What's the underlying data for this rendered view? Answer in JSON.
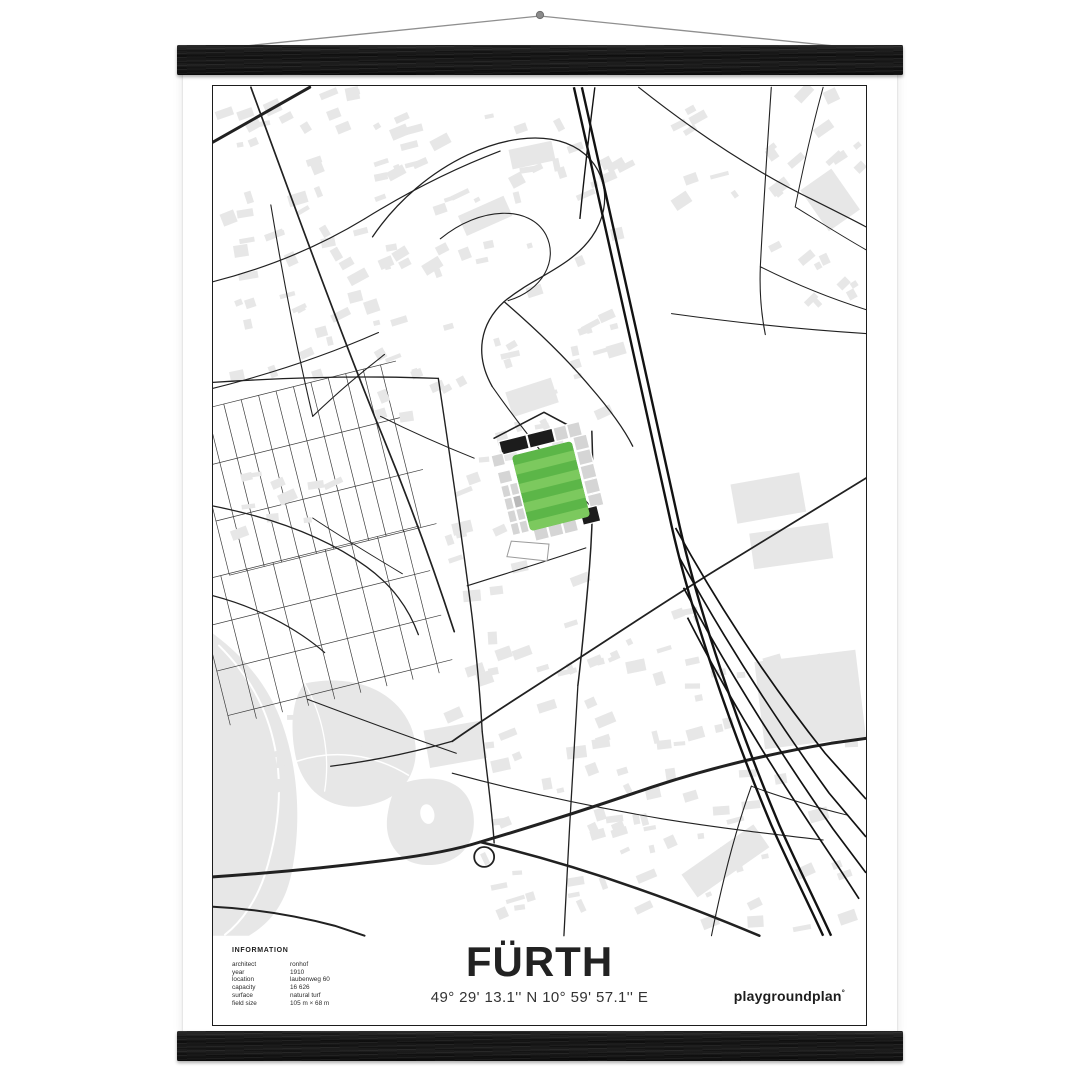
{
  "scene": {
    "wall_color": "#ffffff",
    "hanger_color": "#1a1a1a",
    "string_color": "#8f8f8f"
  },
  "poster": {
    "title": "FÜRTH",
    "coordinates": "49° 29' 13.1'' N  10° 59' 57.1'' E",
    "brand": "playgroundplan",
    "brand_mark": "°",
    "info": {
      "heading": "INFORMATION",
      "rows": [
        {
          "label": "architect",
          "value": "ronhof"
        },
        {
          "label": "year",
          "value": "1910"
        },
        {
          "label": "location",
          "value": "laubenweg 60"
        },
        {
          "label": "capacity",
          "value": "16 626"
        },
        {
          "label": "surface",
          "value": "natural turf"
        },
        {
          "label": "field size",
          "value": "105 m × 68 m"
        }
      ]
    }
  },
  "map": {
    "colors": {
      "road": "#212121",
      "rail": "#121212",
      "building": "#e7e7e7",
      "green": "#e7e7e7",
      "pitch": "#5cb648",
      "pitchStripe": "#7cc95e",
      "stand": "#d5d5d5",
      "standMid": "#b9b9b9",
      "standDark": "#1c1c1c",
      "grid": "#3c3c3c"
    },
    "greys": [
      "M0,548 C30,570 56,600 70,640 C86,686 88,738 80,782 C74,818 58,838 36,851 L0,851 Z",
      "M92,598 C140,588 182,604 198,640 C212,674 198,708 164,718 C126,730 94,712 84,676 C77,648 78,614 92,598 Z",
      "M190,698 C228,686 256,698 261,728 C266,762 242,782 212,780 C186,778 171,757 175,730 C178,712 181,704 190,698 Z"
    ],
    "whitePaths": [
      {
        "d": "M6,560 C36,590 54,622 62,662 C70,702 66,746 52,790 C44,814 30,836 12,850",
        "w": 2
      },
      {
        "d": "M84,676 C120,664 160,668 196,690",
        "w": 1.5
      },
      {
        "d": "M92,598 C110,630 118,668 112,706",
        "w": 1.3
      }
    ],
    "holes": [
      {
        "cx": 215,
        "cy": 729,
        "rx": 7,
        "ry": 10,
        "rot": -12
      }
    ],
    "grids": [
      {
        "cx": 100,
        "cy": 382,
        "w": 214,
        "h": 168,
        "a": -14,
        "sx": 18,
        "sy": 56
      },
      {
        "cx": 112,
        "cy": 540,
        "w": 232,
        "h": 148,
        "a": -14,
        "sx": 27,
        "sy": 46
      }
    ],
    "clusters": [
      {
        "x": 6,
        "y": 4,
        "w": 214,
        "h": 286,
        "n": 64,
        "a": -20,
        "seed": 11
      },
      {
        "x": 166,
        "y": 8,
        "w": 252,
        "h": 334,
        "n": 66,
        "a": -20,
        "seed": 23
      },
      {
        "x": 556,
        "y": 4,
        "w": 96,
        "h": 212,
        "n": 22,
        "a": -35,
        "seed": 37
      },
      {
        "x": 238,
        "y": 470,
        "w": 252,
        "h": 372,
        "n": 70,
        "a": -15,
        "seed": 41
      },
      {
        "x": 350,
        "y": 716,
        "w": 300,
        "h": 128,
        "n": 26,
        "a": -15,
        "seed": 53
      },
      {
        "x": 10,
        "y": 306,
        "w": 118,
        "h": 148,
        "n": 10,
        "a": -14,
        "seed": 61
      },
      {
        "x": 480,
        "y": 560,
        "w": 170,
        "h": 140,
        "n": 14,
        "a": -10,
        "seed": 71
      },
      {
        "x": 228,
        "y": 350,
        "w": 118,
        "h": 112,
        "n": 14,
        "a": -15,
        "seed": 83
      },
      {
        "x": 56,
        "y": 620,
        "w": 120,
        "h": 88,
        "n": 8,
        "a": -10,
        "seed": 89
      },
      {
        "x": 430,
        "y": 4,
        "w": 100,
        "h": 120,
        "n": 8,
        "a": -25,
        "seed": 97
      }
    ],
    "bigBuildings": [
      {
        "x": 548,
        "y": 570,
        "w": 102,
        "h": 88,
        "r": -7
      },
      {
        "x": 522,
        "y": 392,
        "w": 70,
        "h": 40,
        "r": -10
      },
      {
        "x": 540,
        "y": 442,
        "w": 80,
        "h": 36,
        "r": -8
      },
      {
        "x": 470,
        "y": 762,
        "w": 88,
        "h": 28,
        "r": -35
      },
      {
        "x": 214,
        "y": 640,
        "w": 58,
        "h": 38,
        "r": -10
      },
      {
        "x": 296,
        "y": 298,
        "w": 48,
        "h": 26,
        "r": -18
      },
      {
        "x": 248,
        "y": 118,
        "w": 50,
        "h": 22,
        "r": -24
      },
      {
        "x": 298,
        "y": 58,
        "w": 44,
        "h": 20,
        "r": -12
      },
      {
        "x": 600,
        "y": 88,
        "w": 38,
        "h": 50,
        "r": -35
      }
    ],
    "roads": [
      {
        "d": "M0,55 L97,0",
        "w": 3
      },
      {
        "d": "M38,0 C80,115 122,230 162,330 C192,402 218,472 242,546",
        "w": 1.7
      },
      {
        "d": "M0,296 C75,291 152,289 226,292",
        "w": 1.3
      },
      {
        "d": "M226,292 C238,372 250,452 260,532 C264,568 268,606 270,646",
        "w": 1.4
      },
      {
        "d": "M270,646 C275,692 280,725 282,758",
        "w": 1.4
      },
      {
        "d": "M0,195 C55,181 106,160 152,132",
        "w": 1.2
      },
      {
        "d": "M152,132 C194,106 238,83 288,64",
        "w": 1.2
      },
      {
        "d": "M0,302 C60,287 116,268 166,246",
        "w": 1.1
      },
      {
        "d": "M58,118 C70,190 84,262 100,330",
        "w": 1.1
      },
      {
        "d": "M100,330 C122,309 146,288 172,268",
        "w": 1.1
      },
      {
        "d": "M160,150 C210,76 300,36 354,56 C394,71 404,116 380,150 C358,181 322,190 292,215 C268,237 262,268 280,300",
        "w": 1.3
      },
      {
        "d": "M228,152 C268,119 318,118 334,148 C347,174 330,204 296,214",
        "w": 1.1
      },
      {
        "d": "M292,215 C322,241 352,269 378,300 C398,323 412,342 421,360",
        "w": 1.3
      },
      {
        "d": "M280,300 C301,330 322,357 346,386",
        "w": 1.1
      },
      {
        "d": "M282,352 L332,326 L362,342 L368,357",
        "w": 1.6
      },
      {
        "d": "M380,345 C382,396 381,448 376,500 C373,534 370,567 366,600",
        "w": 1.5
      },
      {
        "d": "M366,600 C361,682 356,768 352,851",
        "w": 1.3
      },
      {
        "d": "M255,500 C296,487 336,475 374,462",
        "w": 1.1
      },
      {
        "d": "M655,392 C610,420 564,448 518,476 C458,512 394,556 340,590 C300,616 268,636 240,656",
        "w": 1.8
      },
      {
        "d": "M240,656 C198,668 158,676 118,681",
        "w": 1.3
      },
      {
        "d": "M240,688 C310,707 382,722 452,734 C508,743 560,749 612,755",
        "w": 1.1
      },
      {
        "d": "M427,0 C485,46 546,86 604,114 C622,123 640,132 655,140",
        "w": 1.2
      },
      {
        "d": "M460,227 C525,236 590,243 655,247",
        "w": 1.1
      },
      {
        "d": "M560,0 C556,60 552,120 549,180 C548,206 550,228 554,248",
        "w": 1.1
      },
      {
        "d": "M549,180 C585,198 620,212 655,223",
        "w": 1
      },
      {
        "d": "M0,420 C56,431 110,449 154,481 C180,500 196,522 206,549",
        "w": 1.3
      },
      {
        "d": "M0,510 C42,521 82,541 112,567",
        "w": 1.2
      },
      {
        "d": "M95,614 C140,631 192,650 244,668",
        "w": 1.1
      },
      {
        "d": "M500,851 C510,801 522,751 540,701",
        "w": 1.1
      },
      {
        "d": "M540,701 C572,713 604,722 636,730",
        "w": 1
      },
      {
        "d": "M0,792 C60,788 122,782 176,775 C216,770 246,764 268,757 C322,741 382,722 440,702 C498,683 560,668 620,658 L655,653",
        "w": 3
      },
      {
        "d": "M268,757 C322,770 382,788 432,806 C472,820 512,836 548,851",
        "w": 2.6
      },
      {
        "d": "M0,822 C42,824 84,831 122,841 L152,851",
        "w": 2
      },
      {
        "circle": [
          272,
          772,
          10
        ],
        "w": 1.8
      },
      {
        "d": "M168,330 C200,346 232,360 262,372",
        "w": 1
      },
      {
        "d": "M346,386 C360,400 372,412 382,424",
        "w": 1
      },
      {
        "d": "M100,432 C130,452 160,470 190,488",
        "w": 0.9
      },
      {
        "d": "M612,0 C601,40 592,80 584,120",
        "w": 1
      },
      {
        "d": "M584,120 C610,136 632,150 655,163",
        "w": 0.9
      }
    ],
    "railway": {
      "main": [
        "M362,0 C394,140 428,296 460,440 C480,528 518,640 560,740 C576,776 594,812 612,851",
        "M370,0 C402,140 436,296 468,440 C488,528 526,640 568,740 C584,776 602,812 620,851"
      ],
      "aux": [
        "M383,0 C377,48 372,92 368,132"
      ],
      "sidings": [
        "M464,442 C508,522 560,600 614,668 L655,714",
        "M468,472 C514,556 566,636 618,708 L655,752",
        "M472,502 C520,592 572,672 622,744 L655,788",
        "M476,532 C524,626 576,706 626,780 L648,814"
      ]
    },
    "stadium": {
      "cx": 339,
      "cy": 400,
      "rot": -14,
      "pitch": {
        "x": -31,
        "y": -39,
        "w": 62,
        "h": 78,
        "rx": 4,
        "stripes": 8
      },
      "cells": [
        {
          "x": -40,
          "y": -56,
          "w": 28,
          "h": 14,
          "f": "b"
        },
        {
          "x": -11,
          "y": -56,
          "w": 26,
          "h": 14,
          "f": "b"
        },
        {
          "x": 16,
          "y": -56,
          "w": 13,
          "h": 14,
          "f": "s"
        },
        {
          "x": 30,
          "y": -56,
          "w": 13,
          "h": 14,
          "f": "s"
        },
        {
          "x": -51,
          "y": -44,
          "w": 12,
          "h": 12,
          "f": "s"
        },
        {
          "x": -49,
          "y": -26,
          "w": 13,
          "h": 12,
          "f": "s"
        },
        {
          "x": 33,
          "y": -42,
          "w": 14,
          "h": 14,
          "f": "s"
        },
        {
          "x": 33,
          "y": -27,
          "w": 14,
          "h": 14,
          "f": "s"
        },
        {
          "x": 33,
          "y": -12,
          "w": 14,
          "h": 14,
          "f": "s"
        },
        {
          "x": 33,
          "y": 3,
          "w": 14,
          "h": 14,
          "f": "s"
        },
        {
          "x": 33,
          "y": 18,
          "w": 14,
          "h": 13,
          "f": "s"
        },
        {
          "x": 22,
          "y": 30,
          "w": 18,
          "h": 16,
          "f": "b"
        },
        {
          "x": -28,
          "y": 36,
          "w": 14,
          "h": 14,
          "f": "s"
        },
        {
          "x": -13,
          "y": 36,
          "w": 14,
          "h": 14,
          "f": "s"
        },
        {
          "x": 2,
          "y": 36,
          "w": 14,
          "h": 14,
          "f": "s"
        },
        {
          "x": -49,
          "y": -12,
          "w": 8,
          "h": 12,
          "f": "s"
        },
        {
          "x": -49,
          "y": 1,
          "w": 8,
          "h": 12,
          "f": "s"
        },
        {
          "x": -49,
          "y": 14,
          "w": 8,
          "h": 12,
          "f": "s"
        },
        {
          "x": -49,
          "y": 27,
          "w": 8,
          "h": 12,
          "f": "s"
        },
        {
          "x": -40,
          "y": -12,
          "w": 8,
          "h": 12,
          "f": "s"
        },
        {
          "x": -40,
          "y": 1,
          "w": 8,
          "h": 12,
          "f": "m"
        },
        {
          "x": -40,
          "y": 14,
          "w": 8,
          "h": 12,
          "f": "s"
        },
        {
          "x": -40,
          "y": 27,
          "w": 8,
          "h": 12,
          "f": "s"
        }
      ],
      "forecourt": "-52,44 -16,56 -22,72 -60,58"
    }
  }
}
